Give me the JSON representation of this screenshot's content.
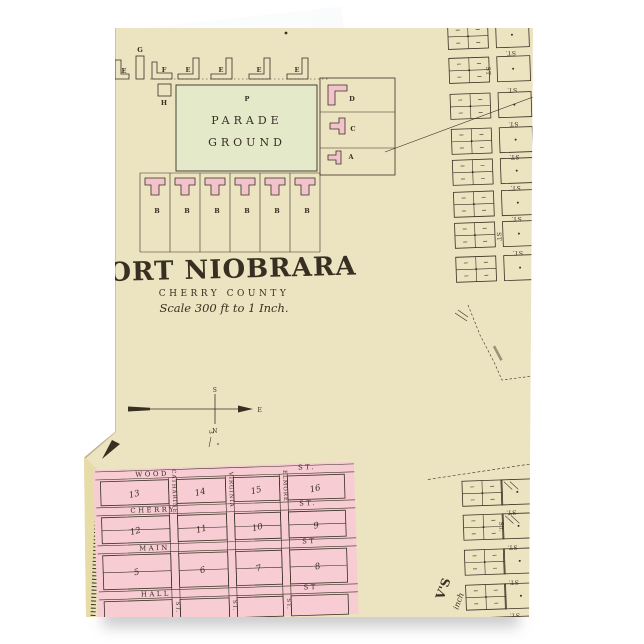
{
  "colors": {
    "page": "#ffffff",
    "card": "#ece3c1",
    "back": "#f4f6f8",
    "parade": "#e4e9ca",
    "pink": "#f7ccd2",
    "bldg": "#f2c3cb",
    "strip": "#e7dca8",
    "ink": "#382f23",
    "edge": "#b9ad8d"
  },
  "fort": {
    "parade": {
      "marker": "P",
      "line1": "PARADE",
      "line2": "GROUND"
    },
    "top_row": [
      "E",
      "G",
      "F",
      "E",
      "E",
      "E",
      "E"
    ],
    "h_building": "H",
    "side_buildings": [
      "D",
      "C",
      "A"
    ],
    "barracks": [
      "B",
      "B",
      "B",
      "B",
      "B",
      "B"
    ]
  },
  "title_block": {
    "title": "FORT NIOBRARA",
    "county": "CHERRY COUNTY",
    "scale": "Scale 300 ft to 1 Inch."
  },
  "compass": {
    "top": "S",
    "bottom": "N",
    "east": "E"
  },
  "marks": {
    "section_number": "3"
  },
  "town_plat": {
    "h_streets": [
      {
        "name": "WOOD",
        "suffix": "ST."
      },
      {
        "name": "CHERRY",
        "suffix": "ST."
      },
      {
        "name": "MAIN",
        "suffix": "ST"
      },
      {
        "name": "HALL",
        "suffix": "ST"
      }
    ],
    "v_streets": [
      {
        "name": "CATHARINE",
        "suffix": "ST."
      },
      {
        "name": "VIRGINIA",
        "suffix": "ST."
      },
      {
        "name": "ELMORE",
        "suffix": "ST."
      }
    ],
    "block_rows": [
      [
        "13",
        "14",
        "15",
        "16"
      ],
      [
        "12",
        "11",
        "10",
        "9"
      ],
      [
        "5",
        "6",
        "7",
        "8"
      ]
    ]
  },
  "right_plat": {
    "street": "ST.",
    "street_short": "ST"
  },
  "fragments": {
    "rotated_name": "V'S",
    "scale_fragment": "inch"
  }
}
